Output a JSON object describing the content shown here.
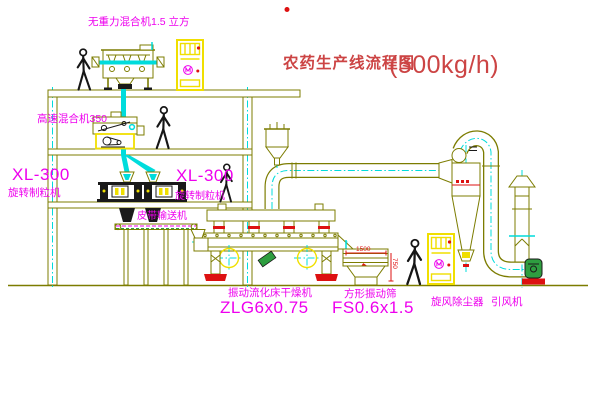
{
  "diagram": {
    "title": "农药生产线流程图",
    "capacity": "(500kg/h)"
  },
  "labels": {
    "gravity_mixer": "无重力混合机1.5 立方",
    "high_speed_mixer": "高速混合机350",
    "granulator_left_model": "XL-300",
    "granulator_left_name": "旋转制粒机",
    "granulator_right_model": "XL-300",
    "granulator_right_name": "旋转制粒机",
    "belt_conveyor": "皮带输送机",
    "dryer_name": "振动流化床干燥机",
    "dryer_model": "ZLG6x0.75",
    "screen_name": "方形振动筛",
    "screen_model": "FS0.6x1.5",
    "cyclone": "旋风除尘器",
    "fan": "引风机"
  },
  "dimensions": {
    "screen_length": "1500",
    "screen_height": "750"
  },
  "colors": {
    "line": "#7c7c00",
    "cyan": "#00dcdc",
    "yellow": "#f0df00",
    "magenta": "#ee00ee",
    "red": "#dd1111",
    "green": "#2e9e40",
    "title": "#cc4444"
  }
}
